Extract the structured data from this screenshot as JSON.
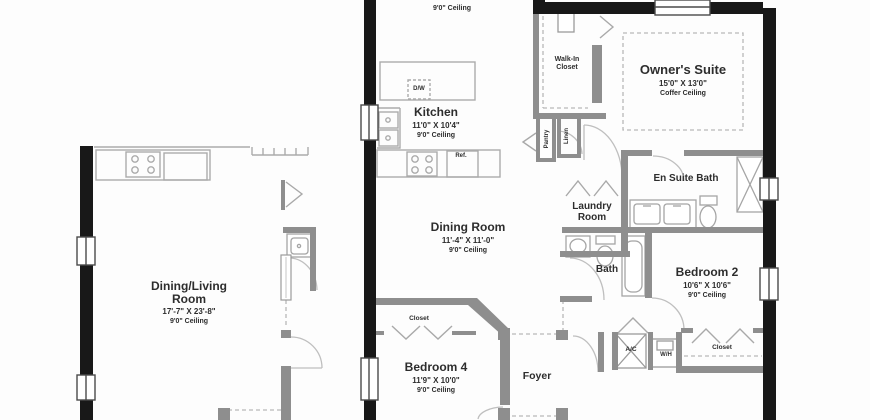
{
  "plan": {
    "rooms": {
      "top_partial": {
        "dims_partial": "15'8\" X 15'4\"",
        "ceiling": "9'0\" Ceiling"
      },
      "kitchen": {
        "name": "Kitchen",
        "dims": "11'0\" X 10'4\"",
        "ceiling": "9'0\" Ceiling"
      },
      "walk_in_closet": {
        "line1": "Walk-In",
        "line2": "Closet"
      },
      "owners_suite": {
        "name": "Owner's Suite",
        "dims": "15'0\" X 13'0\"",
        "ceiling": "Coffer Ceiling"
      },
      "dining_room": {
        "name": "Dining Room",
        "dims": "11'-4\" X 11'-0\"",
        "ceiling": "9'0\" Ceiling"
      },
      "dining_living": {
        "line1": "Dining/Living",
        "line2": "Room",
        "dims": "17'-7\" X 23'-8\"",
        "ceiling": "9'0\" Ceiling"
      },
      "laundry": {
        "line1": "Laundry",
        "line2": "Room"
      },
      "en_suite_bath": {
        "name": "En Suite Bath"
      },
      "bath": {
        "name": "Bath"
      },
      "bedroom2": {
        "name": "Bedroom 2",
        "dims": "10'6\" X 10'6\"",
        "ceiling": "9'0\" Ceiling"
      },
      "bedroom4": {
        "name": "Bedroom 4",
        "dims": "11'9\" X 10'0\"",
        "ceiling": "9'0\" Ceiling"
      },
      "foyer": {
        "name": "Foyer"
      }
    },
    "labels": {
      "pantry": "Pantry",
      "linen": "Linen",
      "dishwasher": "D/W",
      "refrigerator": "Ref.",
      "ac": "A/C",
      "water_heater": "W/H",
      "closet_bedroom2": "Closet",
      "closet_bedroom4": "Closet"
    },
    "colors": {
      "exterior_wall": "#181818",
      "interior_wall": "#8e8e8e",
      "fixture_line": "#aaaaaa",
      "dashed_line": "#b8b8b8",
      "text": "#2d2d2d",
      "background": "#fdfdfd"
    }
  }
}
